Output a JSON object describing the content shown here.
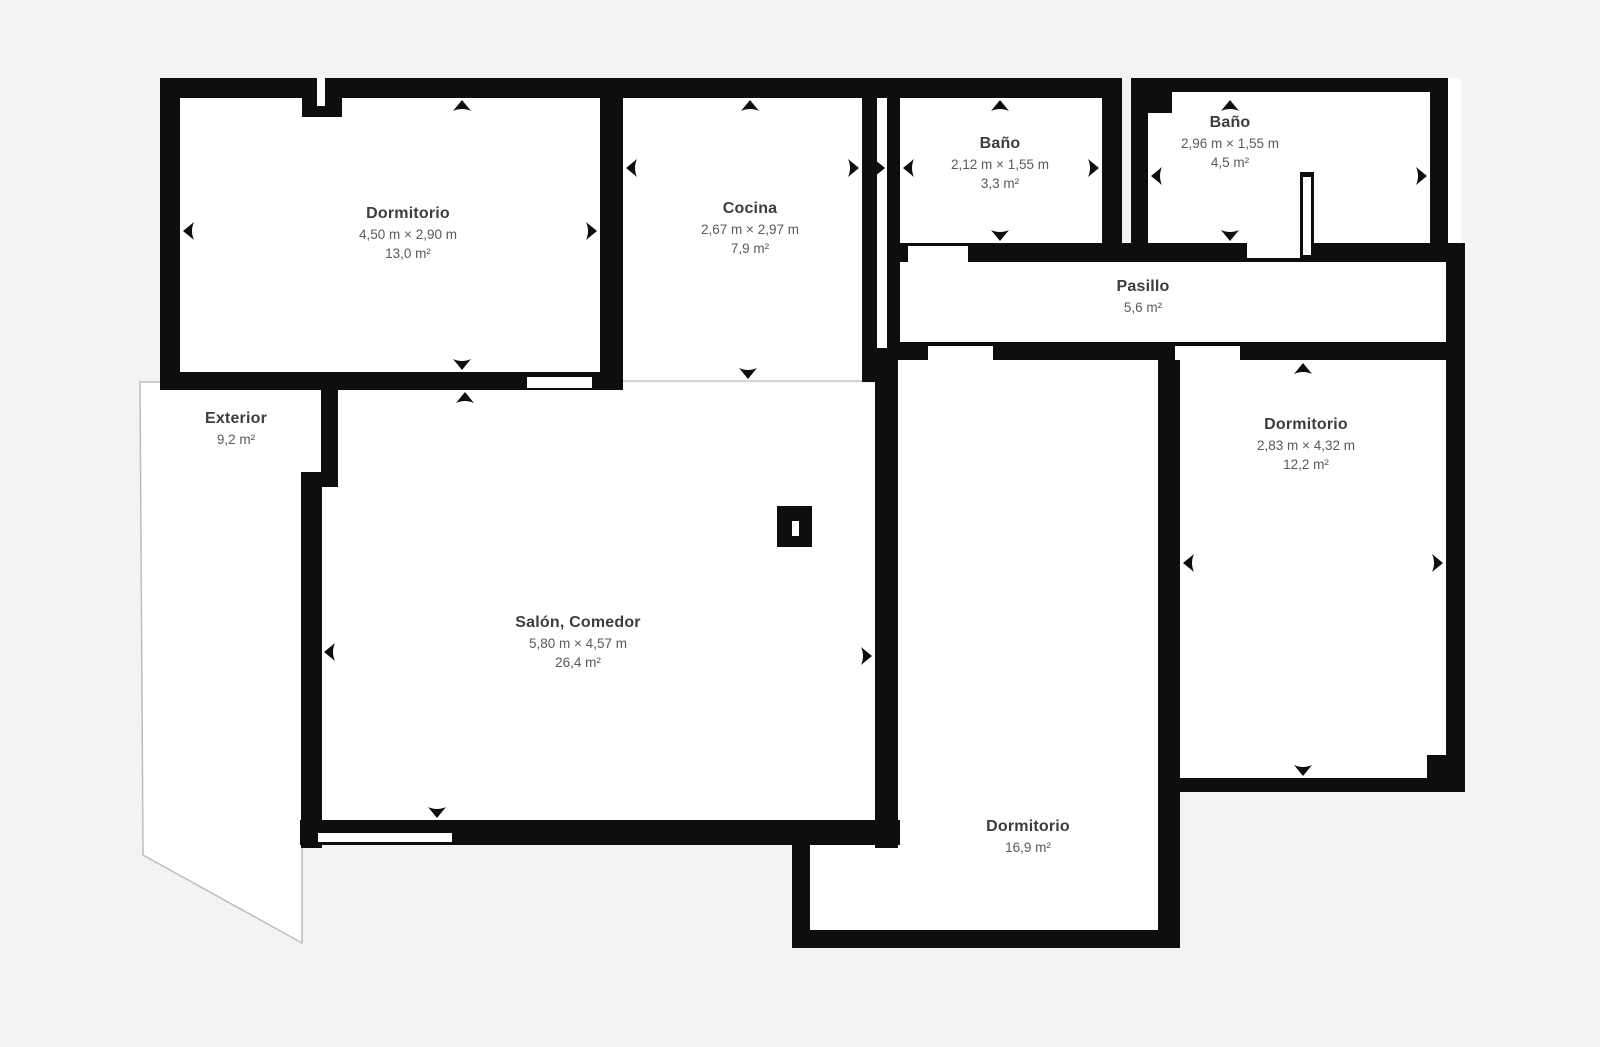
{
  "plan": {
    "type": "floor-plan",
    "language": "es",
    "colors": {
      "background": "#f4f3f1",
      "wall": "#0e0e0e",
      "room_fill": "#ffffff",
      "label_title": "#3d3d3d",
      "label_sub": "#5a5a5a",
      "open_boundary_line": "#c9c9c9",
      "exterior_border": "#bdbdbd"
    }
  },
  "rooms": [
    {
      "id": "dormitorio-1",
      "name": "Dormitorio",
      "dims": "4,50 m × 2,90 m",
      "area": "13,0 m²"
    },
    {
      "id": "cocina",
      "name": "Cocina",
      "dims": "2,67 m × 2,97 m",
      "area": "7,9 m²"
    },
    {
      "id": "bano-1",
      "name": "Baño",
      "dims": "2,12 m × 1,55 m",
      "area": "3,3 m²"
    },
    {
      "id": "bano-2",
      "name": "Baño",
      "dims": "2,96 m × 1,55 m",
      "area": "4,5 m²"
    },
    {
      "id": "pasillo",
      "name": "Pasillo",
      "area": "5,6 m²"
    },
    {
      "id": "exterior",
      "name": "Exterior",
      "area": "9,2 m²"
    },
    {
      "id": "salon-comedor",
      "name": "Salón, Comedor",
      "dims": "5,80 m × 4,57 m",
      "area": "26,4 m²"
    },
    {
      "id": "dormitorio-2",
      "name": "Dormitorio",
      "dims": "2,83 m × 4,32 m",
      "area": "12,2 m²"
    },
    {
      "id": "dormitorio-3",
      "name": "Dormitorio",
      "area": "16,9 m²"
    }
  ]
}
